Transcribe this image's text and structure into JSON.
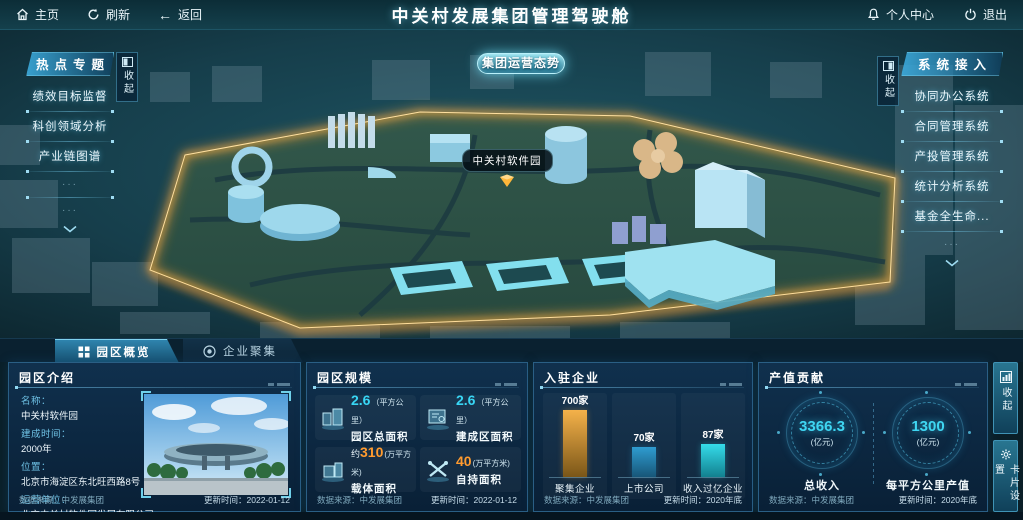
{
  "topbar": {
    "home_label": "主页",
    "refresh_label": "刷新",
    "back_label": "返回",
    "title": "中关村发展集团管理驾驶舱",
    "personal_label": "个人中心",
    "exit_label": "退出"
  },
  "map": {
    "overview_button": "集团运营态势",
    "marker_label": "中关村软件园"
  },
  "left_panel": {
    "title": "热点专题",
    "collapse_label": "收起",
    "items": [
      "绩效目标监督",
      "科创领域分析",
      "产业链图谱"
    ],
    "ellipsis": "···"
  },
  "right_panel": {
    "title": "系统接入",
    "collapse_label": "收起",
    "items": [
      "协同办公系统",
      "合同管理系统",
      "产投管理系统",
      "统计分析系统",
      "基金全生命..."
    ],
    "ellipsis": "···"
  },
  "tabs": {
    "park_overview": "园区概览",
    "enterprise_cluster": "企业聚集"
  },
  "intro_panel": {
    "title": "园区介绍",
    "fields": [
      {
        "label": "名称：",
        "value": "中关村软件园"
      },
      {
        "label": "建成时间：",
        "value": "2000年"
      },
      {
        "label": "位置：",
        "value": "北京市海淀区东北旺西路8号"
      },
      {
        "label": "运营单位：",
        "value": "北京中关村软件园发展有限公司"
      }
    ],
    "footer": {
      "source_label": "数据来源：",
      "source": "中发展集团",
      "updated_label": "更新时间：",
      "updated": "2022-01-12"
    }
  },
  "scale_panel": {
    "title": "园区规模",
    "stats": [
      {
        "prefix": "",
        "value": "2.6",
        "unit": "（平方公里）",
        "name": "园区总面积",
        "color": "#38d6f5"
      },
      {
        "prefix": "",
        "value": "2.6",
        "unit": "（平方公里）",
        "name": "建成区面积",
        "color": "#38d6f5"
      },
      {
        "prefix": "约",
        "value": "310",
        "unit": "(万平方米)",
        "name": "载体面积",
        "color": "#ff9b2f"
      },
      {
        "prefix": "",
        "value": "40",
        "unit": "(万平方米)",
        "name": "自持面积",
        "color": "#ff9b2f"
      }
    ],
    "footer": {
      "source_label": "数据来源：",
      "source": "中发展集团",
      "updated_label": "更新时间：",
      "updated": "2022-01-12"
    }
  },
  "enterprise_panel": {
    "title": "入驻企业",
    "footer": {
      "source_label": "数据来源：",
      "source": "中发展集团",
      "updated_label": "更新时间：",
      "updated": "2020年底"
    }
  },
  "output_panel": {
    "title": "产值贡献",
    "gauges": [
      {
        "value": "3366.3",
        "unit": "(亿元)",
        "name": "总收入"
      },
      {
        "value": "1300",
        "unit": "(亿元)",
        "name": "每平方公里产值"
      }
    ],
    "footer": {
      "source_label": "数据来源：",
      "source": "中发展集团",
      "updated_label": "更新时间：",
      "updated": "2020年底"
    }
  },
  "side_buttons": {
    "collapse_label": "收起",
    "card_settings_label": "卡片设置"
  },
  "chart_data": {
    "type": "bar",
    "title": "入驻企业",
    "categories": [
      "聚集企业",
      "上市公司",
      "收入过亿企业"
    ],
    "values": [
      700,
      70,
      87
    ],
    "value_labels": [
      "700家",
      "70家",
      "87家"
    ],
    "bar_colors_top": [
      "#f5b24a",
      "#2f9cd0",
      "#35dcea"
    ],
    "bar_colors_bottom": [
      "#7a5618",
      "#175678",
      "#12808f"
    ],
    "display_heights_px": [
      67,
      30,
      33
    ],
    "xlabel": "",
    "ylabel": "",
    "legend": false,
    "grid": false
  },
  "colors": {
    "accent_cyan": "#38d6f5",
    "accent_orange": "#ff9b2f",
    "glow_gold": "#ffb23e"
  }
}
